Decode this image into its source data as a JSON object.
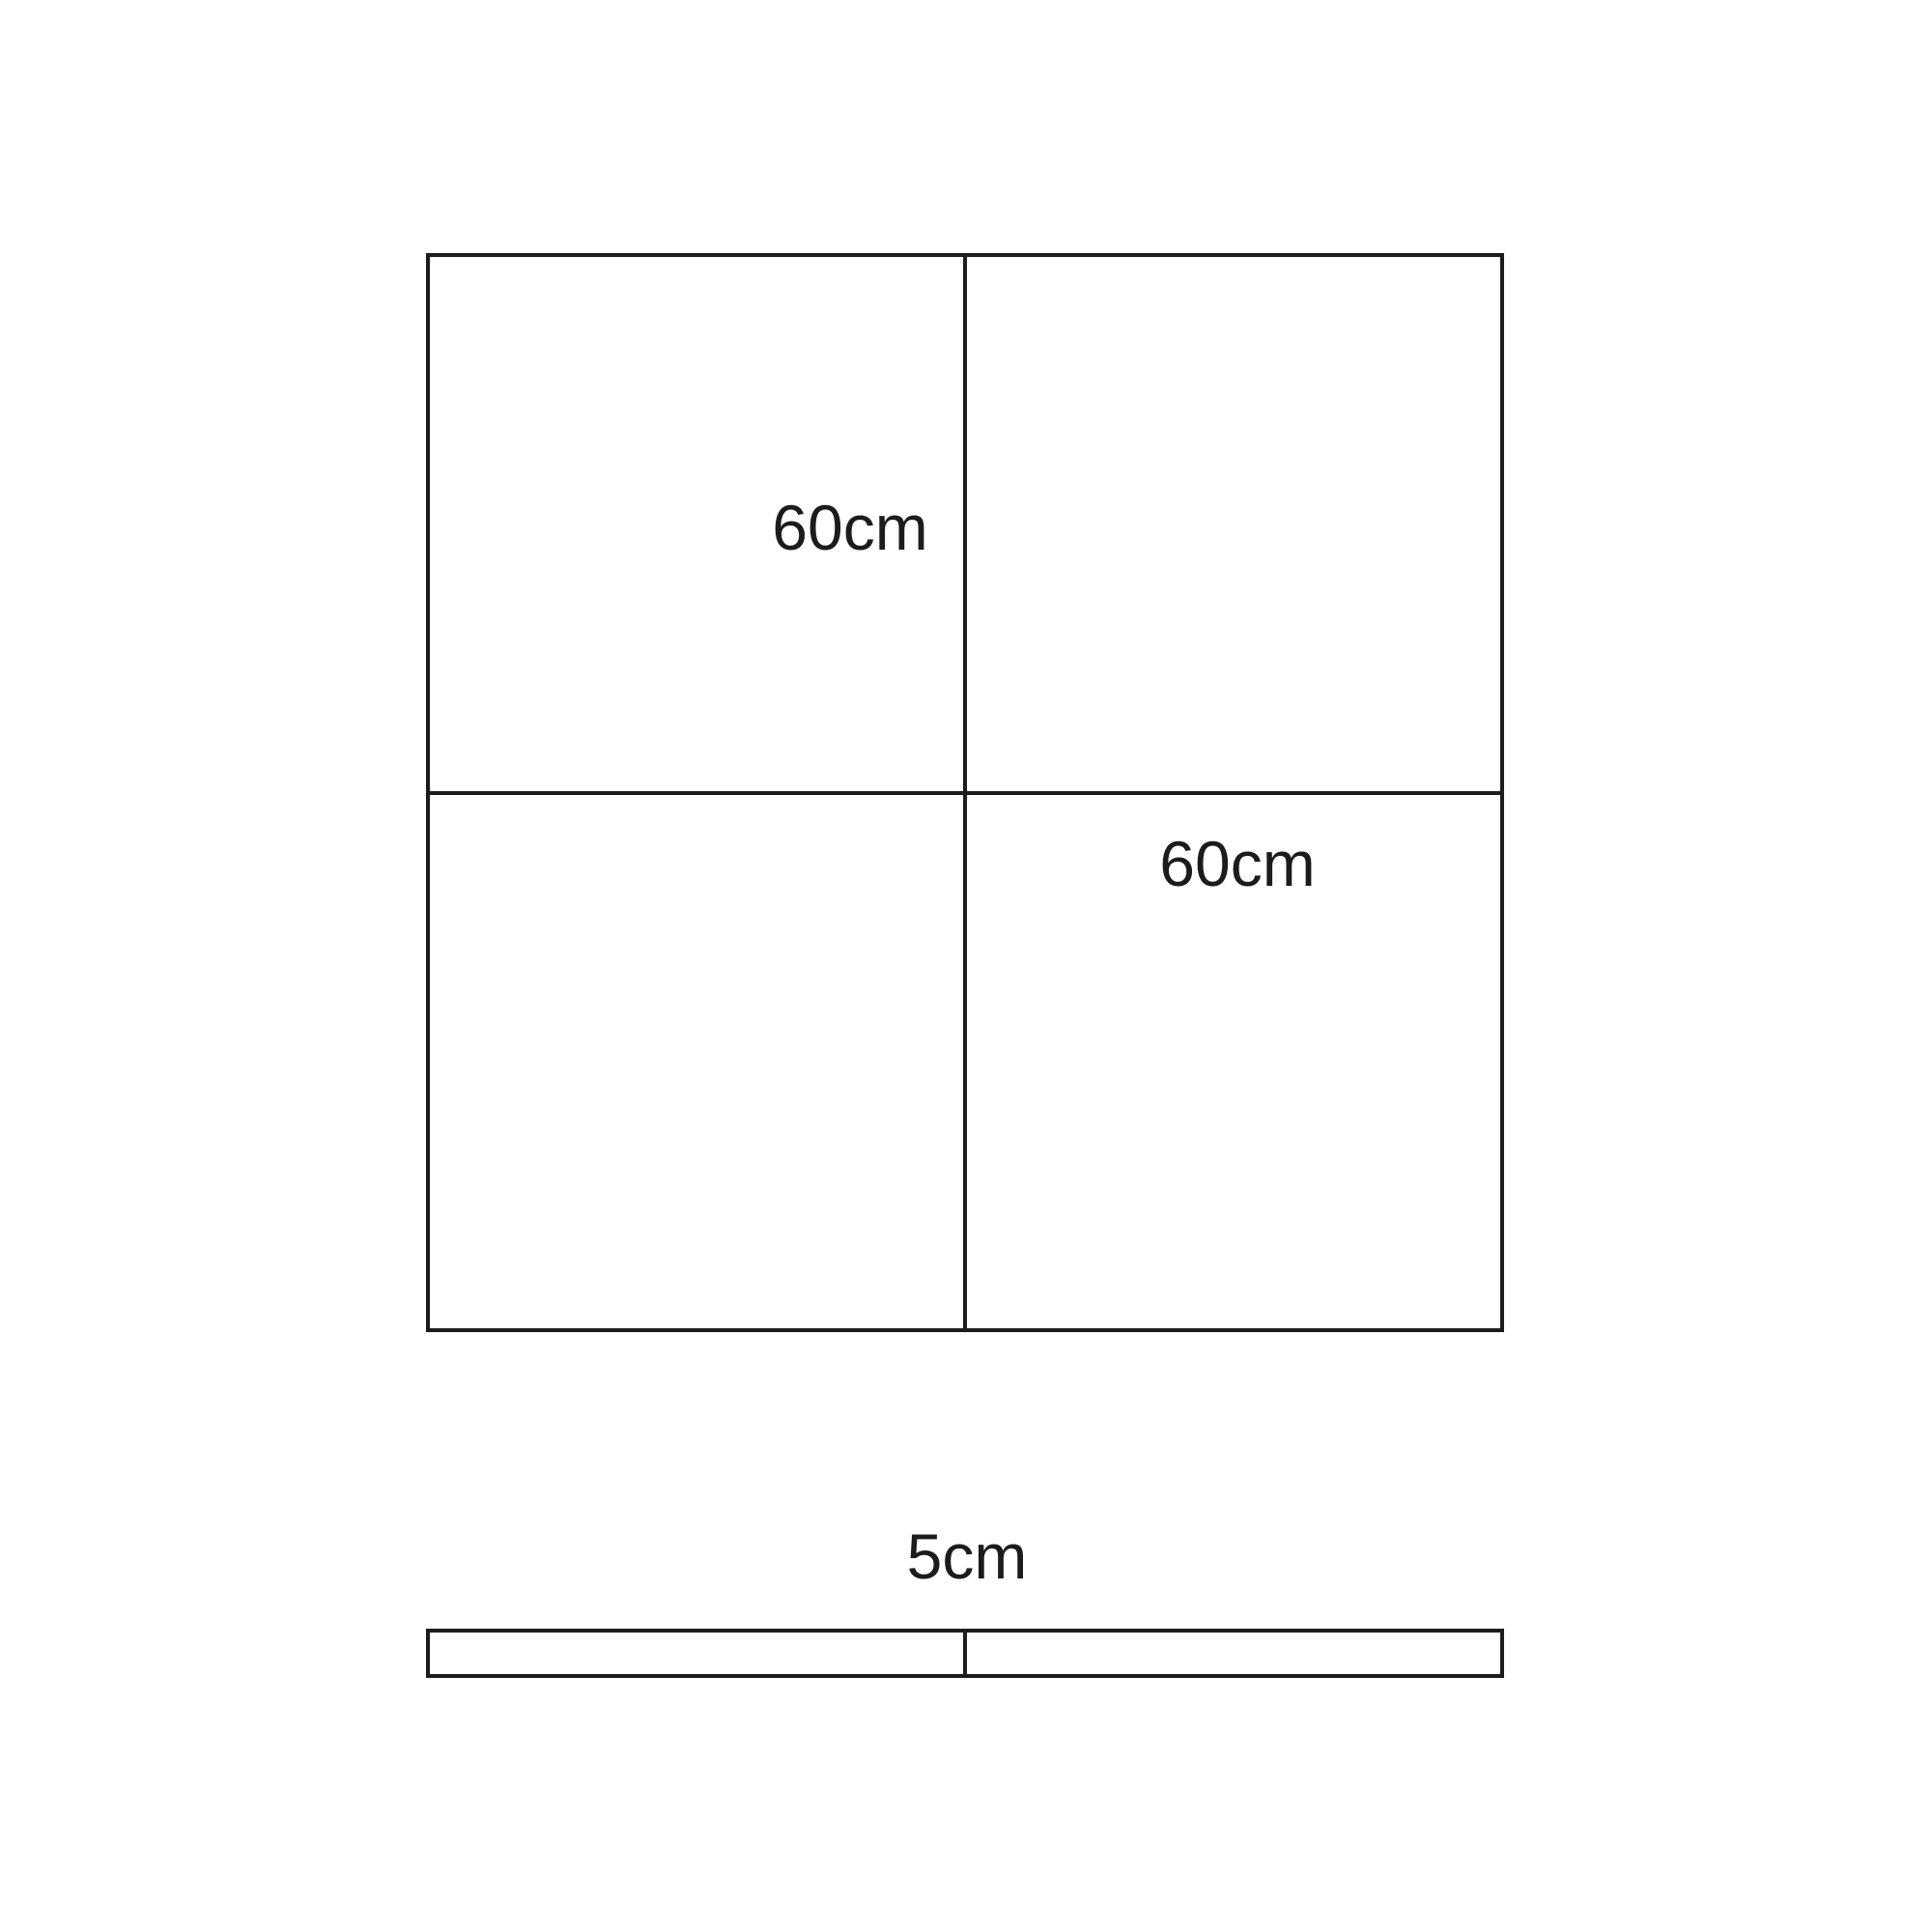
{
  "page": {
    "background_color": "#ffffff",
    "line_color": "#1c1c1c"
  },
  "figure": {
    "square_grid": {
      "description": "large square divided into four equal quadrants",
      "labels": {
        "top_left_quadrant": "60cm",
        "bottom_right_quadrant": "60cm"
      }
    },
    "strip": {
      "description": "thin horizontal rectangle divided into two equal halves",
      "label": "5cm"
    }
  }
}
